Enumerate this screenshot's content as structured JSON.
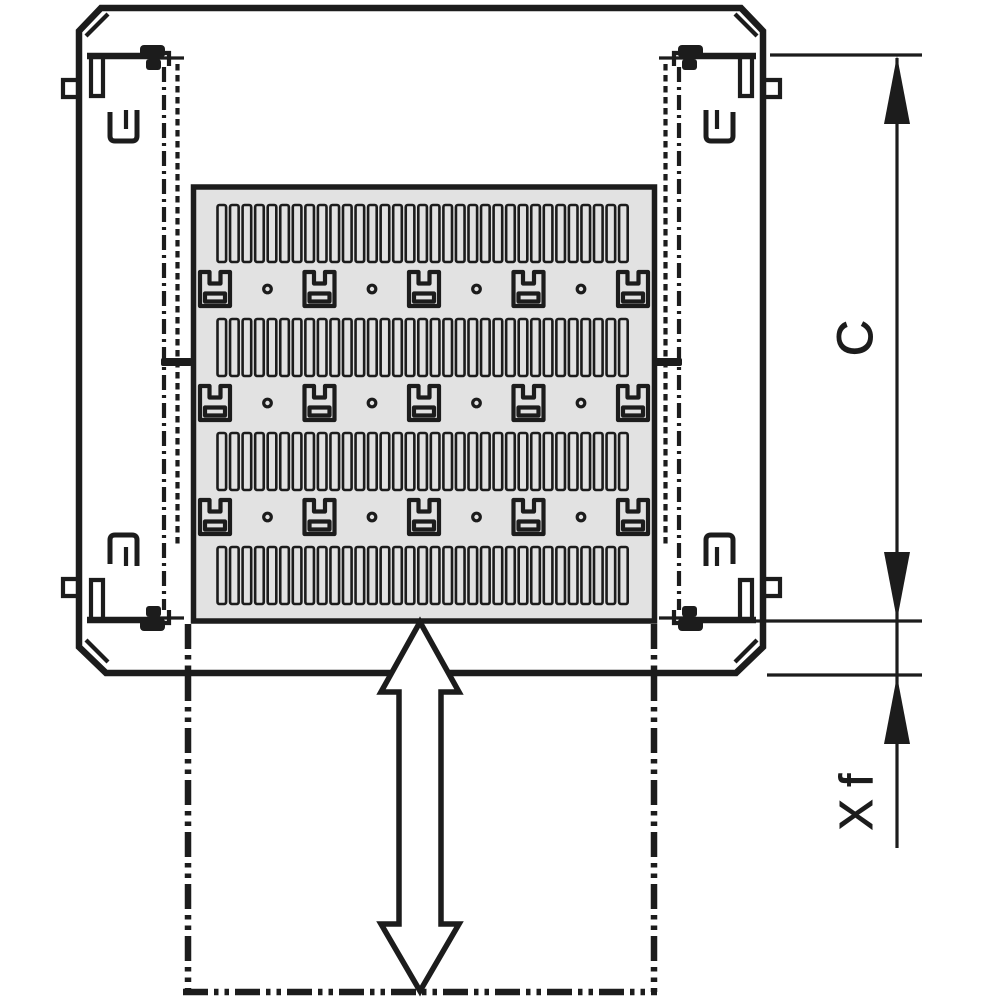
{
  "drawing": {
    "kind": "technical-line-drawing: cabinet top view with perforated sliding shelf",
    "labels": {
      "depth": "C",
      "extension": "X f"
    },
    "colors": {
      "line": "#1c1c1c",
      "shelf_fill": "#e2e2e2",
      "background": "#ffffff"
    },
    "shelf_pattern": {
      "vent_slot_rows": 4,
      "slots_per_row": 33,
      "mount_cutout_rows": 3,
      "mount_cutouts_per_row": 5,
      "round_holes_per_row": 4
    },
    "annotations": {
      "slide_arrow": "vertical double-headed outline arrow",
      "phantom_outline": "dash-dot extended shelf position"
    }
  }
}
